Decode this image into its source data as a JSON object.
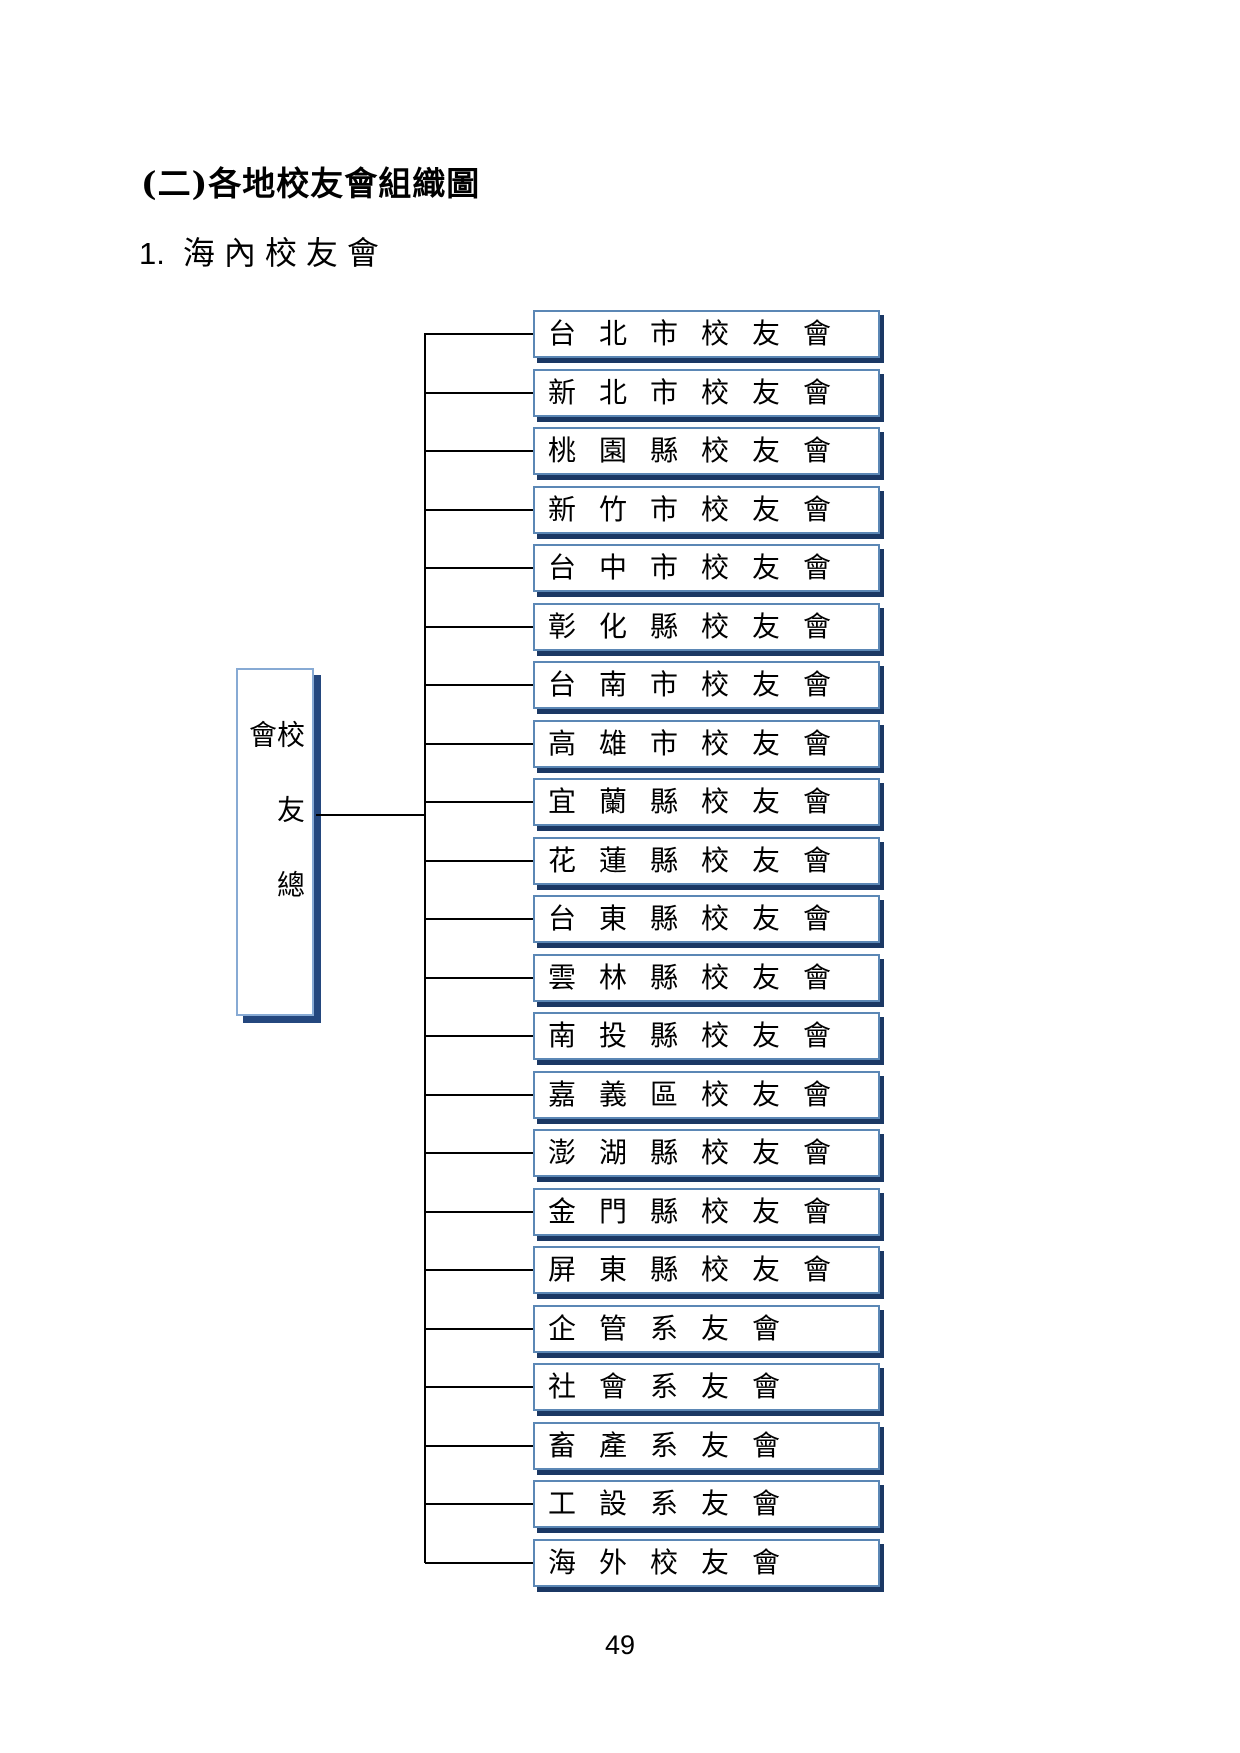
{
  "page": {
    "title": "(二)各地校友會組織圖",
    "section_number": "1.",
    "section_title": "海內校友會",
    "page_number": "49"
  },
  "chart": {
    "type": "org-chart",
    "root_label": "校友總會",
    "branches": [
      "台北市校友會",
      "新北市校友會",
      "桃園縣校友會",
      "新竹市校友會",
      "台中市校友會",
      "彰化縣校友會",
      "台南市校友會",
      "高雄市校友會",
      "宜蘭縣校友會",
      "花蓮縣校友會",
      "台東縣校友會",
      "雲林縣校友會",
      "南投縣校友會",
      "嘉義區校友會",
      "澎湖縣校友會",
      "金門縣校友會",
      "屏東縣校友會",
      "企管系友會",
      "社會系友會",
      "畜產系友會",
      "工設系友會",
      "海外校友會"
    ],
    "colors": {
      "box_border": "#5B87B5",
      "box_border_first": "#1F6FC0",
      "box_shadow": "#1B3864",
      "root_border": "#87AAD4",
      "root_shadow": "#24477E",
      "line": "#000000"
    }
  }
}
